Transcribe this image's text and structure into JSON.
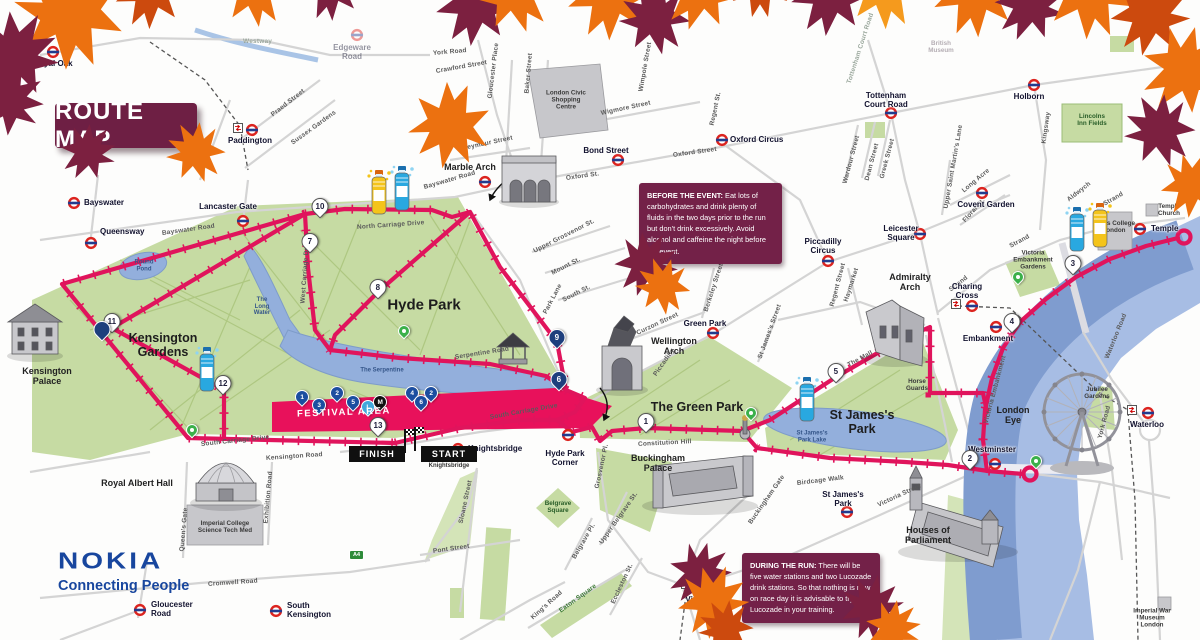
{
  "title": "ROUTE MAP",
  "logo": {
    "brand": "NOKIA",
    "tagline": "Connecting People"
  },
  "info": {
    "before": {
      "heading": "BEFORE THE EVENT:",
      "body": " Eat lots of carbohydrates and drink plenty of fluids in the two days prior to the run but don't drink excessively. Avoid alcohol and caffeine the night before the event."
    },
    "during": {
      "heading": "DURING THE RUN:",
      "body": " There will be five water stations and two Lucozade drink stations. So that nothing is new on race day it is advisable to try Lucozade in your training."
    }
  },
  "start_finish": {
    "finish": "FINISH",
    "start": "START",
    "street": "Knightsbridge"
  },
  "festival": {
    "label": "FESTIVAL AREA"
  },
  "badges": [
    {
      "t": "A4",
      "x": 349,
      "y": 550
    }
  ],
  "colors": {
    "route": "#e0145c",
    "maroon": "#6e1f44",
    "nokia_blue": "#18469e",
    "park": "#c6dba3",
    "water": "#93afdc",
    "leaf": {
      "o": "#ec7110",
      "O": "#f59a1d",
      "m": "#7c2040",
      "r": "#cc4a0e"
    }
  },
  "mile_markers": [
    {
      "n": "1",
      "x": 646,
      "y": 430
    },
    {
      "n": "2",
      "x": 970,
      "y": 467
    },
    {
      "n": "3",
      "x": 1073,
      "y": 272
    },
    {
      "n": "4",
      "x": 1012,
      "y": 330
    },
    {
      "n": "5",
      "x": 836,
      "y": 380
    },
    {
      "n": "6",
      "x": 559,
      "y": 388,
      "style": "navy"
    },
    {
      "n": "7",
      "x": 310,
      "y": 250
    },
    {
      "n": "8",
      "x": 378,
      "y": 296
    },
    {
      "n": "9",
      "x": 557,
      "y": 346,
      "style": "navy"
    },
    {
      "n": "10",
      "x": 320,
      "y": 215
    },
    {
      "n": "11",
      "x": 112,
      "y": 330
    },
    {
      "n": "12",
      "x": 223,
      "y": 392
    },
    {
      "n": "13",
      "x": 378,
      "y": 434
    },
    {
      "n": "",
      "x": 102,
      "y": 338,
      "style": "navy"
    }
  ],
  "festival_markers": [
    {
      "n": "1",
      "x": 302,
      "y": 404
    },
    {
      "n": "3",
      "x": 319,
      "y": 412
    },
    {
      "n": "2",
      "x": 337,
      "y": 400
    },
    {
      "n": "5",
      "x": 353,
      "y": 409
    },
    {
      "n": "L",
      "x": 368,
      "y": 414,
      "style": "light"
    },
    {
      "n": "M",
      "x": 380,
      "y": 409,
      "style": "dark"
    },
    {
      "n": "4",
      "x": 412,
      "y": 400
    },
    {
      "n": "6",
      "x": 421,
      "y": 409
    },
    {
      "n": "2",
      "x": 431,
      "y": 400
    }
  ],
  "green_pins": [
    {
      "x": 192,
      "y": 436
    },
    {
      "x": 404,
      "y": 337
    },
    {
      "x": 751,
      "y": 419
    },
    {
      "x": 1018,
      "y": 283
    },
    {
      "x": 1036,
      "y": 467
    }
  ],
  "bottles": [
    {
      "kind": "lucozade",
      "x": 366,
      "y": 168
    },
    {
      "kind": "water",
      "x": 389,
      "y": 164
    },
    {
      "kind": "water",
      "x": 194,
      "y": 345
    },
    {
      "kind": "water",
      "x": 794,
      "y": 375
    },
    {
      "kind": "water",
      "x": 1064,
      "y": 205
    },
    {
      "kind": "lucozade",
      "x": 1087,
      "y": 201
    }
  ],
  "stations": [
    {
      "name": "Royal Oak",
      "x": 53,
      "y": 52,
      "lx": 53,
      "ly": 60,
      "a": "c"
    },
    {
      "name": "Paddington",
      "x": 252,
      "y": 130,
      "lx": 250,
      "ly": 137,
      "a": "c",
      "rail": [
        238,
        128
      ]
    },
    {
      "name": "Bayswater",
      "x": 74,
      "y": 203,
      "lx": 84,
      "ly": 199,
      "a": "l"
    },
    {
      "name": "Queensway",
      "x": 91,
      "y": 243,
      "lx": 100,
      "ly": 228,
      "a": "l"
    },
    {
      "name": "Lancaster Gate",
      "x": 243,
      "y": 221,
      "lx": 228,
      "ly": 203,
      "a": "c"
    },
    {
      "name": "Marble Arch",
      "x": 485,
      "y": 182,
      "a": "n"
    },
    {
      "name": "Bond Street",
      "x": 618,
      "y": 160,
      "lx": 606,
      "ly": 147,
      "a": "c"
    },
    {
      "name": "Oxford Circus",
      "x": 722,
      "y": 140,
      "lx": 730,
      "ly": 136,
      "a": "l"
    },
    {
      "name": "Tottenham\nCourt Road",
      "x": 891,
      "y": 113,
      "lx": 886,
      "ly": 92,
      "a": "c"
    },
    {
      "name": "Holborn",
      "x": 1034,
      "y": 85,
      "lx": 1029,
      "ly": 93,
      "a": "c"
    },
    {
      "name": "Covent Garden",
      "x": 982,
      "y": 193,
      "lx": 986,
      "ly": 201,
      "a": "c"
    },
    {
      "name": "Leicester\nSquare",
      "x": 920,
      "y": 234,
      "lx": 901,
      "ly": 225,
      "a": "c"
    },
    {
      "name": "Piccadilly\nCircus",
      "x": 828,
      "y": 261,
      "lx": 823,
      "ly": 238,
      "a": "c"
    },
    {
      "name": "Green Park",
      "x": 713,
      "y": 333,
      "lx": 705,
      "ly": 320,
      "a": "c"
    },
    {
      "name": "Hyde Park\nCorner",
      "x": 568,
      "y": 435,
      "lx": 565,
      "ly": 450,
      "a": "c"
    },
    {
      "name": "Knightsbridge",
      "x": 458,
      "y": 449,
      "lx": 468,
      "ly": 445,
      "a": "l"
    },
    {
      "name": "St James's\nPark",
      "x": 847,
      "y": 512,
      "lx": 843,
      "ly": 491,
      "a": "c"
    },
    {
      "name": "Victoria",
      "x": 701,
      "y": 588,
      "lx": 700,
      "ly": 596,
      "a": "c",
      "rail": [
        686,
        584
      ]
    },
    {
      "name": "Westminster",
      "x": 995,
      "y": 464,
      "lx": 992,
      "ly": 446,
      "a": "c"
    },
    {
      "name": "Embankment",
      "x": 996,
      "y": 327,
      "lx": 988,
      "ly": 335,
      "a": "c"
    },
    {
      "name": "Charing\nCross",
      "x": 972,
      "y": 306,
      "lx": 967,
      "ly": 283,
      "a": "c",
      "rail": [
        956,
        304
      ]
    },
    {
      "name": "Waterloo",
      "x": 1148,
      "y": 413,
      "lx": 1147,
      "ly": 421,
      "a": "c",
      "rail": [
        1132,
        410
      ]
    },
    {
      "name": "Temple",
      "x": 1140,
      "y": 229,
      "lx": 1151,
      "ly": 225,
      "a": "l"
    },
    {
      "name": "Gloucester\nRoad",
      "x": 140,
      "y": 610,
      "lx": 151,
      "ly": 601,
      "a": "l"
    },
    {
      "name": "South\nKensington",
      "x": 276,
      "y": 611,
      "lx": 287,
      "ly": 602,
      "a": "l"
    },
    {
      "name": "Edgeware\nRoad",
      "x": 357,
      "y": 35,
      "lx": 352,
      "ly": 44,
      "a": "c",
      "faded": true
    }
  ],
  "streets": [
    {
      "t": "Westway",
      "x": 243,
      "y": 38,
      "r": 0,
      "cls": "faint"
    },
    {
      "t": "Praed Street",
      "x": 272,
      "y": 112,
      "r": -38
    },
    {
      "t": "Sussex Gardens",
      "x": 292,
      "y": 140,
      "r": -36
    },
    {
      "t": "York Road",
      "x": 433,
      "y": 50,
      "r": -5
    },
    {
      "t": "Crawford Street",
      "x": 436,
      "y": 68,
      "r": -10
    },
    {
      "t": "Gloucester Place",
      "x": 490,
      "y": 95,
      "r": -83
    },
    {
      "t": "Baker Street",
      "x": 527,
      "y": 90,
      "r": -85
    },
    {
      "t": "Wigmore Street",
      "x": 601,
      "y": 110,
      "r": -12
    },
    {
      "t": "Wimpole Street",
      "x": 641,
      "y": 88,
      "r": -80
    },
    {
      "t": "Seymour Street",
      "x": 463,
      "y": 145,
      "r": -12
    },
    {
      "t": "Oxford St.",
      "x": 566,
      "y": 175,
      "r": -8
    },
    {
      "t": "Oxford Street",
      "x": 673,
      "y": 152,
      "r": -8
    },
    {
      "t": "Regent St.",
      "x": 712,
      "y": 122,
      "r": -78
    },
    {
      "t": "Bayswater Road",
      "x": 162,
      "y": 230,
      "r": -8
    },
    {
      "t": "Bayswater Road",
      "x": 424,
      "y": 184,
      "r": -16
    },
    {
      "t": "North Carriage Drive",
      "x": 357,
      "y": 224,
      "r": -4
    },
    {
      "t": "West Carriage Drive",
      "x": 303,
      "y": 300,
      "r": -86
    },
    {
      "t": "Serpentine Road",
      "x": 455,
      "y": 354,
      "r": -9
    },
    {
      "t": "Upper Grosvenor St.",
      "x": 534,
      "y": 248,
      "r": -27
    },
    {
      "t": "Mount St.",
      "x": 552,
      "y": 270,
      "r": -27
    },
    {
      "t": "South St.",
      "x": 563,
      "y": 297,
      "r": -27
    },
    {
      "t": "Park Lane",
      "x": 545,
      "y": 310,
      "r": -62
    },
    {
      "t": "Curzon Street",
      "x": 637,
      "y": 330,
      "r": -25
    },
    {
      "t": "Piccadilly",
      "x": 655,
      "y": 372,
      "r": -55
    },
    {
      "t": "Berkeley Street",
      "x": 706,
      "y": 308,
      "r": -72
    },
    {
      "t": "St James's Street",
      "x": 760,
      "y": 355,
      "r": -70
    },
    {
      "t": "Haymarket",
      "x": 846,
      "y": 298,
      "r": -72
    },
    {
      "t": "Regent Street",
      "x": 832,
      "y": 303,
      "r": -75
    },
    {
      "t": "Strand",
      "x": 950,
      "y": 287,
      "r": -38
    },
    {
      "t": "Strand",
      "x": 1010,
      "y": 243,
      "r": -28
    },
    {
      "t": "Strand",
      "x": 1104,
      "y": 201,
      "r": -30
    },
    {
      "t": "Aldwych",
      "x": 1068,
      "y": 197,
      "r": -38
    },
    {
      "t": "Kingsway",
      "x": 1044,
      "y": 140,
      "r": -82
    },
    {
      "t": "Long Acre",
      "x": 963,
      "y": 188,
      "r": -40
    },
    {
      "t": "Upper Saint Martin's Lane",
      "x": 946,
      "y": 205,
      "r": -80
    },
    {
      "t": "Floral St.",
      "x": 964,
      "y": 218,
      "r": -48
    },
    {
      "t": "Greek Street",
      "x": 882,
      "y": 175,
      "r": -75
    },
    {
      "t": "Dean Street",
      "x": 867,
      "y": 177,
      "r": -75
    },
    {
      "t": "Wardour Street",
      "x": 845,
      "y": 180,
      "r": -75
    },
    {
      "t": "Tottenham Court Road",
      "x": 849,
      "y": 80,
      "r": -72,
      "cls": "faint"
    },
    {
      "t": "Victoria Embankment",
      "x": 986,
      "y": 420,
      "r": -75
    },
    {
      "t": "Waterloo Road",
      "x": 1107,
      "y": 355,
      "r": -68
    },
    {
      "t": "York Road",
      "x": 1100,
      "y": 435,
      "r": -75
    },
    {
      "t": "The Mall",
      "x": 848,
      "y": 362,
      "r": -28
    },
    {
      "t": "Constitution Hill",
      "x": 638,
      "y": 441,
      "r": -3
    },
    {
      "t": "Birdcage Walk",
      "x": 797,
      "y": 480,
      "r": -7
    },
    {
      "t": "Buckingham Gate",
      "x": 750,
      "y": 520,
      "r": -55
    },
    {
      "t": "Grosvenor Pl.",
      "x": 597,
      "y": 485,
      "r": -78
    },
    {
      "t": "Upper Belgrave St.",
      "x": 601,
      "y": 540,
      "r": -55
    },
    {
      "t": "Belgrave Pl.",
      "x": 574,
      "y": 555,
      "r": -60
    },
    {
      "t": "Eaton Square",
      "x": 560,
      "y": 608,
      "r": -36,
      "cls": "green"
    },
    {
      "t": "Eccleston St.",
      "x": 613,
      "y": 600,
      "r": -65
    },
    {
      "t": "King's Road",
      "x": 532,
      "y": 615,
      "r": -42
    },
    {
      "t": "Pont Street",
      "x": 433,
      "y": 548,
      "r": -8
    },
    {
      "t": "Sloane Street",
      "x": 461,
      "y": 520,
      "r": -78
    },
    {
      "t": "Victoria Street",
      "x": 878,
      "y": 502,
      "r": -25
    },
    {
      "t": "Kensington Road",
      "x": 266,
      "y": 455,
      "r": -4
    },
    {
      "t": "South Carriage Drive",
      "x": 201,
      "y": 441,
      "r": -6
    },
    {
      "t": "South Carriage Drive",
      "x": 490,
      "y": 414,
      "r": -10
    },
    {
      "t": "Queen's Gate",
      "x": 182,
      "y": 548,
      "r": -85
    },
    {
      "t": "Exhibition Road",
      "x": 266,
      "y": 520,
      "r": -85
    },
    {
      "t": "Cromwell Road",
      "x": 208,
      "y": 581,
      "r": -4
    }
  ],
  "labels": [
    {
      "t": "Kensington\nGardens",
      "x": 163,
      "y": 345,
      "cls": "parkname"
    },
    {
      "t": "Hyde Park",
      "x": 424,
      "y": 306,
      "cls": "parkname big"
    },
    {
      "t": "The Green Park",
      "x": 697,
      "y": 407,
      "cls": "parkname"
    },
    {
      "t": "St James's\nPark",
      "x": 862,
      "y": 422,
      "cls": "parkname"
    },
    {
      "t": "The\nLong\nWater",
      "x": 262,
      "y": 307,
      "cls": "water"
    },
    {
      "t": "The Serpentine",
      "x": 382,
      "y": 371,
      "cls": "water"
    },
    {
      "t": "Round\nPond",
      "x": 144,
      "y": 266,
      "cls": "water"
    },
    {
      "t": "St James's\nPark Lake",
      "x": 812,
      "y": 437,
      "cls": "water"
    },
    {
      "t": "Lincolns\nInn Fields",
      "x": 1092,
      "y": 120,
      "cls": "tiny greenlbl"
    },
    {
      "t": "Jubilee\nGardens",
      "x": 1097,
      "y": 393,
      "cls": "tiny"
    },
    {
      "t": "Victoria\nEmbankment\nGardens",
      "x": 1033,
      "y": 260,
      "cls": "tiny"
    },
    {
      "t": "Belgrave\nSquare",
      "x": 558,
      "y": 507,
      "cls": "tiny greenlbl"
    },
    {
      "t": "Horse\nGuards",
      "x": 917,
      "y": 385,
      "cls": "tiny"
    },
    {
      "t": "Kensington\nPalace",
      "x": 47,
      "y": 376,
      "cls": "lm"
    },
    {
      "t": "Royal Albert Hall",
      "x": 137,
      "y": 483,
      "cls": "lm"
    },
    {
      "t": "Marble Arch",
      "x": 470,
      "y": 167,
      "cls": "lm"
    },
    {
      "t": "Wellington\nArch",
      "x": 674,
      "y": 346,
      "cls": "lm"
    },
    {
      "t": "Buckingham\nPalace",
      "x": 658,
      "y": 463,
      "cls": "lm"
    },
    {
      "t": "Admiralty\nArch",
      "x": 910,
      "y": 282,
      "cls": "lm"
    },
    {
      "t": "Houses of\nParliament",
      "x": 928,
      "y": 535,
      "cls": "lm"
    },
    {
      "t": "London\nEye",
      "x": 1013,
      "y": 415,
      "cls": "lm"
    },
    {
      "t": "Imperial College\nScience Tech Med",
      "x": 225,
      "y": 527,
      "cls": "tiny"
    },
    {
      "t": "Kings College\nLondon",
      "x": 1114,
      "y": 227,
      "cls": "tiny"
    },
    {
      "t": "Temple\nChurch",
      "x": 1169,
      "y": 210,
      "cls": "tiny"
    },
    {
      "t": "British\nMuseum",
      "x": 941,
      "y": 47,
      "cls": "tiny faint"
    },
    {
      "t": "Imperial War\nMuseum London",
      "x": 1152,
      "y": 618,
      "cls": "tiny"
    },
    {
      "t": "London Civic\nShopping\nCentre",
      "x": 566,
      "y": 100,
      "cls": "tiny"
    }
  ],
  "leaves": [
    {
      "x": 70,
      "y": 12,
      "s": 1.4,
      "r": -10,
      "c": "o"
    },
    {
      "x": 15,
      "y": 55,
      "s": 1.1,
      "r": 30,
      "c": "m"
    },
    {
      "x": 8,
      "y": 100,
      "s": 0.9,
      "r": 60,
      "c": "m"
    },
    {
      "x": 150,
      "y": -8,
      "s": 0.9,
      "r": 15,
      "c": "r"
    },
    {
      "x": 255,
      "y": -10,
      "s": 0.9,
      "r": -20,
      "c": "o"
    },
    {
      "x": 330,
      "y": -12,
      "s": 0.8,
      "r": 10,
      "c": "m"
    },
    {
      "x": 450,
      "y": 125,
      "s": 1.05,
      "r": 190,
      "c": "o"
    },
    {
      "x": 475,
      "y": 5,
      "s": 1.0,
      "r": 20,
      "c": "m"
    },
    {
      "x": 515,
      "y": -8,
      "s": 1.0,
      "r": -30,
      "c": "o"
    },
    {
      "x": 610,
      "y": -5,
      "s": 1.1,
      "r": 15,
      "c": "o"
    },
    {
      "x": 655,
      "y": 18,
      "s": 0.9,
      "r": -25,
      "c": "m"
    },
    {
      "x": 700,
      "y": -10,
      "s": 1.0,
      "r": 30,
      "c": "o"
    },
    {
      "x": 760,
      "y": -15,
      "s": 0.8,
      "r": 0,
      "c": "r"
    },
    {
      "x": 830,
      "y": -5,
      "s": 1.0,
      "r": 20,
      "c": "m"
    },
    {
      "x": 885,
      "y": -12,
      "s": 1.0,
      "r": -15,
      "c": "O"
    },
    {
      "x": 975,
      "y": -8,
      "s": 1.1,
      "r": 10,
      "c": "o"
    },
    {
      "x": 1030,
      "y": 5,
      "s": 0.9,
      "r": 35,
      "c": "m"
    },
    {
      "x": 1090,
      "y": -10,
      "s": 1.2,
      "r": -10,
      "c": "o"
    },
    {
      "x": 1150,
      "y": 15,
      "s": 1.0,
      "r": 25,
      "c": "r"
    },
    {
      "x": 1185,
      "y": 70,
      "s": 1.1,
      "r": 50,
      "c": "o"
    },
    {
      "x": 1160,
      "y": 130,
      "s": 0.9,
      "r": -30,
      "c": "m"
    },
    {
      "x": 1192,
      "y": 185,
      "s": 0.8,
      "r": 20,
      "c": "o"
    },
    {
      "x": 88,
      "y": 152,
      "s": 0.7,
      "r": 40,
      "c": "m"
    },
    {
      "x": 196,
      "y": 152,
      "s": 0.75,
      "r": -30,
      "c": "o"
    },
    {
      "x": 646,
      "y": 264,
      "s": 0.8,
      "r": 30,
      "c": "m"
    },
    {
      "x": 663,
      "y": 286,
      "s": 0.7,
      "r": -20,
      "c": "o"
    },
    {
      "x": 700,
      "y": 574,
      "s": 0.8,
      "r": 50,
      "c": "m"
    },
    {
      "x": 713,
      "y": 602,
      "s": 0.9,
      "r": 20,
      "c": "o"
    },
    {
      "x": 726,
      "y": 628,
      "s": 0.7,
      "r": -30,
      "c": "r"
    },
    {
      "x": 872,
      "y": 608,
      "s": 0.8,
      "r": 10,
      "c": "m"
    },
    {
      "x": 893,
      "y": 628,
      "s": 0.7,
      "r": 45,
      "c": "o"
    }
  ]
}
